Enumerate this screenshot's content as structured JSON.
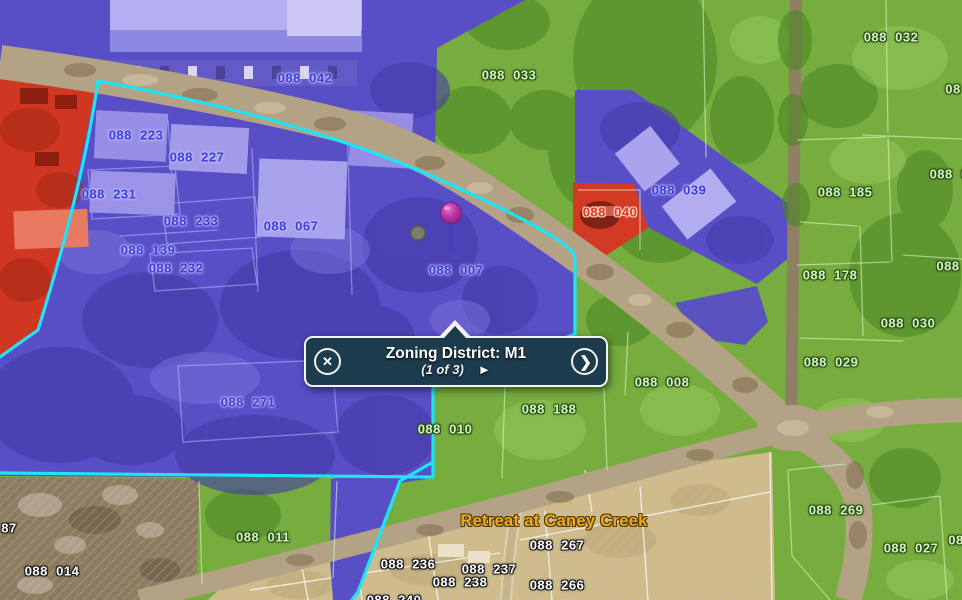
{
  "popup": {
    "title": "Zoning District: M1",
    "page_indicator": "(1 of 3)",
    "close_label": "✕",
    "next_label": "❯",
    "play_label": "►"
  },
  "map": {
    "colors": {
      "zone_blue": "#584ec6",
      "zone_green": "#76ad3e",
      "zone_red": "#cf3722",
      "selection_cyan": "#1fe3f7",
      "road_tan": "#b3a283",
      "subdivision_tan": "#cdbc92",
      "popup_bg": "#1c3b4d",
      "popup_border": "#f2f4f4",
      "pin_magenta": "#c238a8",
      "label_orange": "#f5a81c"
    },
    "labels": [
      {
        "text": "088  042",
        "x": 305,
        "y": 78,
        "style": "blue"
      },
      {
        "text": "088  223",
        "x": 136,
        "y": 135,
        "style": "blue"
      },
      {
        "text": "088  227",
        "x": 197,
        "y": 157,
        "style": "blue"
      },
      {
        "text": "088  231",
        "x": 109,
        "y": 194,
        "style": "blue"
      },
      {
        "text": "088  233",
        "x": 191,
        "y": 221,
        "style": "blue"
      },
      {
        "text": "088  067",
        "x": 291,
        "y": 226,
        "style": "blue"
      },
      {
        "text": "088  139",
        "x": 148,
        "y": 250,
        "style": "blue"
      },
      {
        "text": "088  232",
        "x": 176,
        "y": 268,
        "style": "blue"
      },
      {
        "text": "088  007",
        "x": 456,
        "y": 270,
        "style": "blue"
      },
      {
        "text": "088  039",
        "x": 679,
        "y": 190,
        "style": "blue"
      },
      {
        "text": "088  271",
        "x": 248,
        "y": 402,
        "style": "blue"
      },
      {
        "text": "088  040",
        "x": 610,
        "y": 212,
        "style": "red"
      },
      {
        "text": "088  033",
        "x": 509,
        "y": 75,
        "style": "green"
      },
      {
        "text": "088  032",
        "x": 891,
        "y": 37,
        "style": "green"
      },
      {
        "text": "088  185",
        "x": 845,
        "y": 192,
        "style": "green"
      },
      {
        "text": "088  178",
        "x": 830,
        "y": 275,
        "style": "green"
      },
      {
        "text": "088  030",
        "x": 908,
        "y": 323,
        "style": "green"
      },
      {
        "text": "088  029",
        "x": 831,
        "y": 362,
        "style": "green"
      },
      {
        "text": "088  008",
        "x": 662,
        "y": 382,
        "style": "green"
      },
      {
        "text": "088  188",
        "x": 549,
        "y": 409,
        "style": "green"
      },
      {
        "text": "088  010",
        "x": 445,
        "y": 429,
        "style": "green"
      },
      {
        "text": "088  269",
        "x": 836,
        "y": 510,
        "style": "green"
      },
      {
        "text": "088  027",
        "x": 911,
        "y": 548,
        "style": "green"
      },
      {
        "text": "088  011",
        "x": 263,
        "y": 537,
        "style": "green"
      },
      {
        "text": "08",
        "x": 953,
        "y": 89,
        "style": "green"
      },
      {
        "text": "088  03",
        "x": 953,
        "y": 174,
        "style": "green"
      },
      {
        "text": "088",
        "x": 948,
        "y": 266,
        "style": "green"
      },
      {
        "text": "08",
        "x": 956,
        "y": 540,
        "style": "green"
      },
      {
        "text": "87",
        "x": 9,
        "y": 528,
        "style": "white"
      },
      {
        "text": "088  014",
        "x": 52,
        "y": 571,
        "style": "white"
      },
      {
        "text": "088  236",
        "x": 408,
        "y": 564,
        "style": "white"
      },
      {
        "text": "088  237",
        "x": 489,
        "y": 569,
        "style": "white"
      },
      {
        "text": "088  238",
        "x": 460,
        "y": 582,
        "style": "white"
      },
      {
        "text": "088  266",
        "x": 557,
        "y": 585,
        "style": "white"
      },
      {
        "text": "088  267",
        "x": 557,
        "y": 545,
        "style": "white"
      },
      {
        "text": "088  240",
        "x": 394,
        "y": 600,
        "style": "white"
      },
      {
        "text": "Retreat at Caney Creek",
        "x": 554,
        "y": 521,
        "style": "orange"
      }
    ]
  }
}
